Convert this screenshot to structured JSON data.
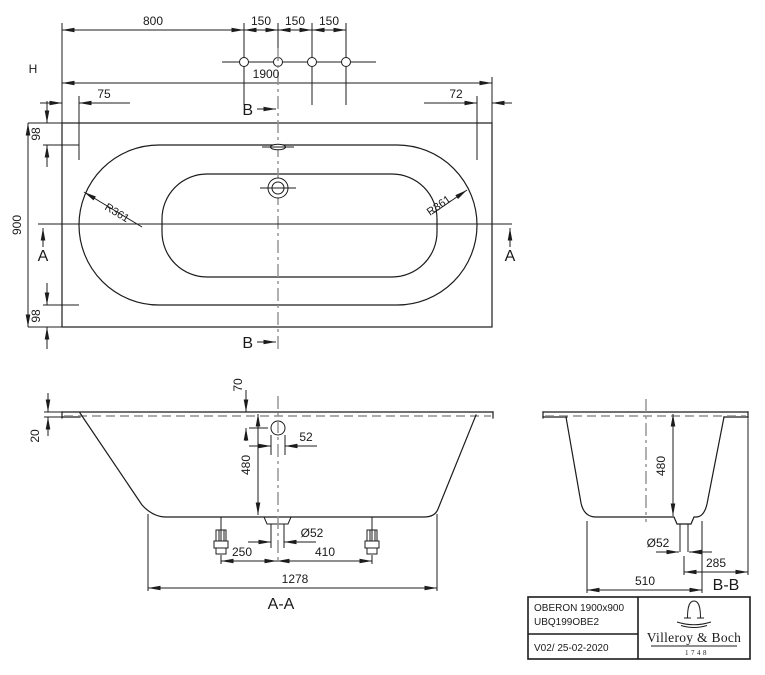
{
  "drawing_title": "Bathtub technical drawing",
  "top_view": {
    "handle_label": "H",
    "dim_800": "800",
    "dim_150_a": "150",
    "dim_150_b": "150",
    "dim_150_c": "150",
    "dim_1900": "1900",
    "dim_75": "75",
    "dim_72": "72",
    "dim_98_top": "98",
    "dim_900": "900",
    "dim_98_bottom": "98",
    "radius_left": "R361",
    "radius_right": "R361",
    "section_a_left": "A",
    "section_a_right": "A",
    "section_b_top": "B",
    "section_b_bottom": "B"
  },
  "section_aa": {
    "dim_70": "70",
    "dim_20": "20",
    "dim_52": "52",
    "dim_480": "480",
    "dia_52": "Ø52",
    "dim_250": "250",
    "dim_410": "410",
    "dim_1278": "1278",
    "title": "A-A"
  },
  "section_bb": {
    "dim_480": "480",
    "dia_52": "Ø52",
    "dim_285": "285",
    "dim_510": "510",
    "title": "B-B"
  },
  "title_block": {
    "product": "OBERON 1900x900",
    "code": "UBQ199OBE2",
    "version": "V02/ 25-02-2020",
    "brand": "Villeroy & Boch",
    "year": "1748"
  }
}
